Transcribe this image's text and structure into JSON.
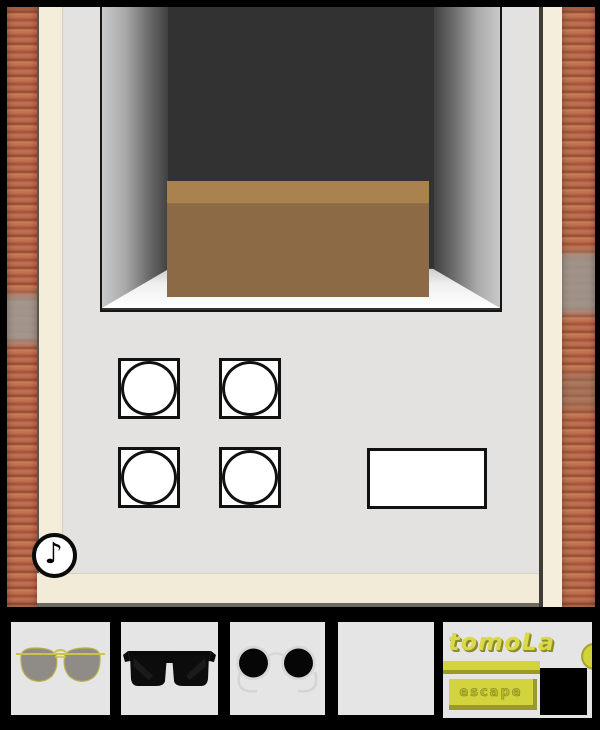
{
  "logo": {
    "title": "tomoLa",
    "subtitle": "escape"
  },
  "controls": {
    "sound_icon_glyph": "♪"
  },
  "scene": {
    "alcove_item": "brown-box",
    "puzzle_buttons": [
      "circle-button-1",
      "circle-button-2",
      "circle-button-3",
      "circle-button-4"
    ],
    "answer_panel": "blank-white-rectangle"
  },
  "inventory": {
    "slots": [
      {
        "item": "aviator-sunglasses"
      },
      {
        "item": "black-sunglasses"
      },
      {
        "item": "round-black-sunglasses"
      },
      {
        "item": "empty"
      },
      {
        "item": "brand-logo"
      }
    ]
  },
  "colors": {
    "background": "#000000",
    "brick": "#b5654a",
    "frame_cream": "#f4edda",
    "panel_face": "#e3e2e0",
    "niche_back": "#323232",
    "box_lid": "#a9824f",
    "box_front": "#8c6a45",
    "accent_yellow": "#d3d33d",
    "slot_background": "#e5e5e5"
  }
}
